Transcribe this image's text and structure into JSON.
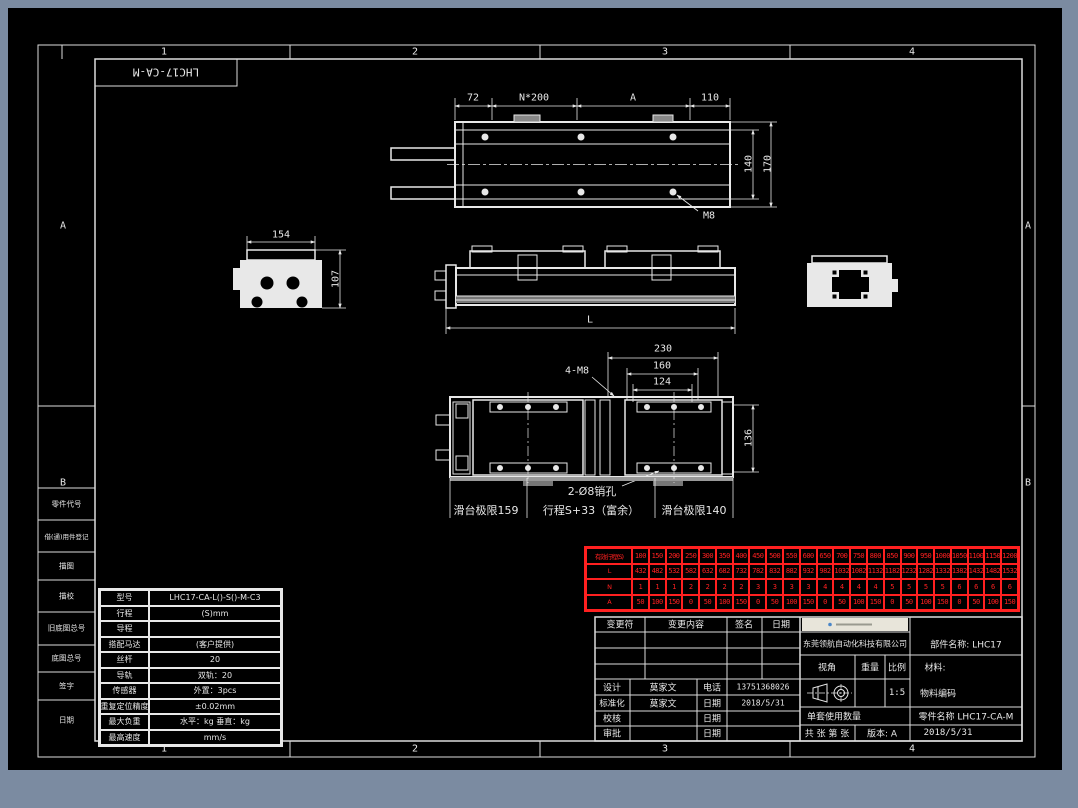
{
  "colors": {
    "background": "#7b8ba1",
    "paper": "#000000",
    "line": "#e8e8e8",
    "table_red": "#ff2020",
    "logo_bg": "#e8e5da"
  },
  "sheet": {
    "zone_cols": [
      "1",
      "2",
      "3",
      "4"
    ],
    "zone_rows": [
      "A",
      "B"
    ],
    "flip_title": "LHC17-CA-M",
    "margin_blocks": [
      "零件代号",
      "借(通)用件登记",
      "描图",
      "描校",
      "旧底图总号",
      "底图总号",
      "签字",
      "日期"
    ]
  },
  "views": {
    "top": {
      "d72": "72",
      "dN": "N*200",
      "dA": "A",
      "d110": "110",
      "d140": "140",
      "d170": "170",
      "m8": "M8"
    },
    "left_end": {
      "d154": "154",
      "d107": "107"
    },
    "side": {
      "dL": "L"
    },
    "plan": {
      "d230": "230",
      "d160": "160",
      "d124": "124",
      "d136": "136",
      "m8_4": "4-M8",
      "pin": "2-Ø8销孔",
      "limit_l": "滑台极限159",
      "stroke": "行程S+33（富余）",
      "limit_r": "滑台极限140"
    }
  },
  "stroke_table": {
    "row_labels": [
      "有效行程(S)",
      "L",
      "N",
      "A"
    ],
    "strokes": [
      "100",
      "150",
      "200",
      "250",
      "300",
      "350",
      "400",
      "450",
      "500",
      "550",
      "600",
      "650",
      "700",
      "750",
      "800",
      "850",
      "900",
      "950",
      "1000",
      "1050",
      "1100",
      "1150",
      "1200"
    ],
    "L": [
      "432",
      "482",
      "532",
      "582",
      "632",
      "682",
      "732",
      "782",
      "832",
      "882",
      "932",
      "982",
      "1032",
      "1082",
      "1132",
      "1182",
      "1232",
      "1282",
      "1332",
      "1382",
      "1432",
      "1482",
      "1532"
    ],
    "N": [
      "1",
      "1",
      "1",
      "2",
      "2",
      "2",
      "2",
      "3",
      "3",
      "3",
      "3",
      "4",
      "4",
      "4",
      "4",
      "5",
      "5",
      "5",
      "5",
      "6",
      "6",
      "6",
      "6"
    ],
    "A": [
      "50",
      "100",
      "150",
      "0",
      "50",
      "100",
      "150",
      "0",
      "50",
      "100",
      "150",
      "0",
      "50",
      "100",
      "150",
      "0",
      "50",
      "100",
      "150",
      "0",
      "50",
      "100",
      "150"
    ]
  },
  "spec_table": {
    "rows": [
      {
        "label": "型号",
        "value": "LHC17-CA-L()-S()-M-C3"
      },
      {
        "label": "行程",
        "value": "(S)mm"
      },
      {
        "label": "导程",
        "value": ""
      },
      {
        "label": "搭配马达",
        "value": "(客户提供)"
      },
      {
        "label": "丝杆",
        "value": "20"
      },
      {
        "label": "导轨",
        "value": "双轨：20"
      },
      {
        "label": "传感器",
        "value": "外置：3pcs"
      },
      {
        "label": "重复定位精度",
        "value": "±0.02mm"
      },
      {
        "label": "最大负重",
        "value": "水平：kg 垂直：kg"
      },
      {
        "label": "最高速度",
        "value": "mm/s"
      }
    ]
  },
  "title_block": {
    "change": {
      "col1": "变更符",
      "col2": "变更内容",
      "col3": "签名",
      "col4": "日期"
    },
    "signoff": [
      {
        "role": "设计",
        "name": "莫家文",
        "field": "电话",
        "value": "13751368026"
      },
      {
        "role": "标准化",
        "name": "莫家文",
        "field": "日期",
        "value": "2018/5/31"
      },
      {
        "role": "校核",
        "name": "",
        "field": "日期",
        "value": ""
      },
      {
        "role": "审批",
        "name": "",
        "field": "日期",
        "value": ""
      }
    ],
    "company": "东莞领航自动化科技有限公司",
    "assembly": "部件名称: LHC17",
    "view_label": "视角",
    "weight_label": "重量",
    "scale_label": "比例",
    "scale_value": "1:5",
    "material_label": "材料:",
    "material_code_label": "物料编码",
    "qty_label": "单套使用数量",
    "part_name": "零件名称 LHC17-CA-M",
    "sheet_count": "共 张 第 张",
    "version": "版本: A",
    "date": "2018/5/31"
  }
}
